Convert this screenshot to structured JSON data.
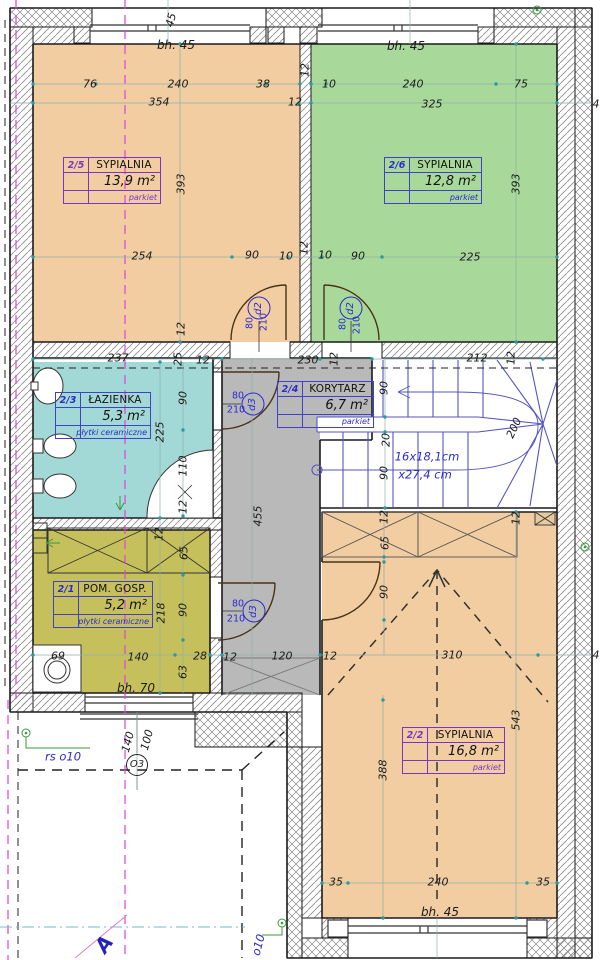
{
  "palette": {
    "bedroom_fill": "#f1cda1",
    "bedroom2_fill": "#a9d89b",
    "bath_fill": "#a2d8d5",
    "utility_fill": "#c6c05c",
    "corridor_fill": "#b9b9b9",
    "stair_line": "#5555c5",
    "label_blue": "#2b2bd0",
    "label_purple": "#7a35c8",
    "tick_teal": "#2e9aa0",
    "axis_magenta": "#e040e0"
  },
  "plan": {
    "rooms": [
      {
        "id": "2/5",
        "name": "SYPIALNIA",
        "area": "13,9 m²",
        "finish": "parkiet"
      },
      {
        "id": "2/6",
        "name": "SYPIALNIA",
        "area": "12,8 m²",
        "finish": "parkiet"
      },
      {
        "id": "2/3",
        "name": "ŁAZIENKA",
        "area": "5,3 m²",
        "finish": "płytki ceramiczne"
      },
      {
        "id": "2/4",
        "name": "KORYTARZ",
        "area": "6,7 m²",
        "finish": "parkiet"
      },
      {
        "id": "2/1",
        "name": "POM. GOSP.",
        "area": "5,2 m²",
        "finish": "płytki ceramiczne"
      },
      {
        "id": "2/2",
        "name": "SYPIALNIA",
        "area": "16,8 m²",
        "finish": "parkiet"
      }
    ]
  },
  "annotations": {
    "dims": [
      {
        "t": "76",
        "x": 90,
        "y": 84
      },
      {
        "t": "240",
        "x": 178,
        "y": 84
      },
      {
        "t": "38",
        "x": 263,
        "y": 84
      },
      {
        "t": "10",
        "x": 329,
        "y": 84
      },
      {
        "t": "240",
        "x": 413,
        "y": 84
      },
      {
        "t": "75",
        "x": 521,
        "y": 84
      },
      {
        "t": "354",
        "x": 159,
        "y": 102
      },
      {
        "t": "12",
        "x": 295,
        "y": 102
      },
      {
        "t": "325",
        "x": 432,
        "y": 104
      },
      {
        "t": "12",
        "x": 305,
        "y": 70,
        "r": -90
      },
      {
        "t": "bh. 45",
        "x": 176,
        "y": 45,
        "cls": "bh"
      },
      {
        "t": "bh. 45",
        "x": 406,
        "y": 46,
        "cls": "bh"
      },
      {
        "t": "393",
        "x": 181,
        "y": 184,
        "r": -90
      },
      {
        "t": "393",
        "x": 516,
        "y": 184,
        "r": -90
      },
      {
        "t": "254",
        "x": 142,
        "y": 256
      },
      {
        "t": "90",
        "x": 252,
        "y": 255
      },
      {
        "t": "10",
        "x": 286,
        "y": 256
      },
      {
        "t": "10",
        "x": 325,
        "y": 255
      },
      {
        "t": "90",
        "x": 358,
        "y": 256
      },
      {
        "t": "225",
        "x": 470,
        "y": 257
      },
      {
        "t": "12",
        "x": 181,
        "y": 329,
        "r": -90
      },
      {
        "t": "12",
        "x": 304,
        "y": 248,
        "r": -90
      },
      {
        "t": "237",
        "x": 118,
        "y": 358
      },
      {
        "t": "25",
        "x": 178,
        "y": 359,
        "r": -90
      },
      {
        "t": "12",
        "x": 203,
        "y": 360
      },
      {
        "t": "230",
        "x": 308,
        "y": 360
      },
      {
        "t": "12",
        "x": 334,
        "y": 359,
        "r": -90
      },
      {
        "t": "212",
        "x": 477,
        "y": 358
      },
      {
        "t": "12",
        "x": 511,
        "y": 358,
        "r": -90
      },
      {
        "t": "90",
        "x": 183,
        "y": 398,
        "r": -90
      },
      {
        "t": "225",
        "x": 160,
        "y": 432,
        "r": -90
      },
      {
        "t": "110",
        "x": 183,
        "y": 466,
        "r": -90
      },
      {
        "t": "12",
        "x": 183,
        "y": 507,
        "r": -90
      },
      {
        "t": "455",
        "x": 258,
        "y": 516,
        "r": -90
      },
      {
        "t": "90",
        "x": 384,
        "y": 388,
        "r": -90
      },
      {
        "t": "20",
        "x": 386,
        "y": 440,
        "r": -90
      },
      {
        "t": "90",
        "x": 384,
        "y": 473,
        "r": -90
      },
      {
        "t": "200",
        "x": 514,
        "y": 428,
        "r": -65
      },
      {
        "t": "16x18,1cm",
        "x": 427,
        "y": 457,
        "cls": "blue-it"
      },
      {
        "t": "x27,4 cm",
        "x": 425,
        "y": 475,
        "cls": "blue-it"
      },
      {
        "t": "12",
        "x": 159,
        "y": 534,
        "r": -90
      },
      {
        "t": "65",
        "x": 184,
        "y": 553,
        "r": -90
      },
      {
        "t": "90",
        "x": 183,
        "y": 610,
        "r": -90
      },
      {
        "t": "63",
        "x": 183,
        "y": 672,
        "r": -90
      },
      {
        "t": "218",
        "x": 161,
        "y": 613,
        "r": -90
      },
      {
        "t": "69",
        "x": 58,
        "y": 656
      },
      {
        "t": "140",
        "x": 138,
        "y": 657
      },
      {
        "t": "28",
        "x": 200,
        "y": 656
      },
      {
        "t": "12",
        "x": 230,
        "y": 657
      },
      {
        "t": "120",
        "x": 282,
        "y": 656
      },
      {
        "t": "bh. 70",
        "x": 136,
        "y": 688,
        "cls": "bh"
      },
      {
        "t": "12",
        "x": 384,
        "y": 517,
        "r": -90
      },
      {
        "t": "65",
        "x": 385,
        "y": 543,
        "r": -90
      },
      {
        "t": "90",
        "x": 384,
        "y": 592,
        "r": -90
      },
      {
        "t": "12",
        "x": 516,
        "y": 518,
        "r": -90
      },
      {
        "t": "12",
        "x": 330,
        "y": 656
      },
      {
        "t": "310",
        "x": 452,
        "y": 655
      },
      {
        "t": "4",
        "x": 596,
        "y": 655
      },
      {
        "t": "543",
        "x": 516,
        "y": 720,
        "r": -90
      },
      {
        "t": "388",
        "x": 383,
        "y": 770,
        "r": -90
      },
      {
        "t": "35",
        "x": 336,
        "y": 882
      },
      {
        "t": "240",
        "x": 438,
        "y": 882
      },
      {
        "t": "35",
        "x": 543,
        "y": 882
      },
      {
        "t": "bh. 45",
        "x": 440,
        "y": 912,
        "cls": "bh"
      },
      {
        "t": "4",
        "x": 596,
        "y": 104
      },
      {
        "t": "140",
        "x": 128,
        "y": 742,
        "r": -75
      },
      {
        "t": "100",
        "x": 147,
        "y": 740,
        "r": -75
      },
      {
        "t": "rs o10",
        "x": 63,
        "y": 757,
        "cls": "blue-it"
      },
      {
        "t": "o10",
        "x": 259,
        "y": 945,
        "r": -75,
        "cls": "blue-it"
      },
      {
        "t": "45",
        "x": 171,
        "y": 20,
        "r": -75
      },
      {
        "t": "80",
        "x": 250,
        "y": 323,
        "r": -90,
        "cls": "blue-sm"
      },
      {
        "t": "210",
        "x": 264,
        "y": 322,
        "r": -90,
        "cls": "blue-sm"
      },
      {
        "t": "80",
        "x": 343,
        "y": 324,
        "r": -90,
        "cls": "blue-sm"
      },
      {
        "t": "210",
        "x": 357,
        "y": 325,
        "r": -90,
        "cls": "blue-sm"
      },
      {
        "t": "80",
        "x": 238,
        "y": 396,
        "cls": "blue-sm"
      },
      {
        "t": "210",
        "x": 236,
        "y": 410,
        "cls": "blue-sm"
      },
      {
        "t": "80",
        "x": 238,
        "y": 604,
        "cls": "blue-sm"
      },
      {
        "t": "210",
        "x": 236,
        "y": 619,
        "cls": "blue-sm"
      },
      {
        "t": "A",
        "x": 104,
        "y": 944,
        "r": -55,
        "cls": "section"
      }
    ],
    "markers": [
      {
        "t": "d2",
        "x": 259,
        "y": 308
      },
      {
        "t": "d2",
        "x": 351,
        "y": 308
      },
      {
        "t": "d3",
        "x": 253,
        "y": 404
      },
      {
        "t": "d3",
        "x": 254,
        "y": 611
      },
      {
        "t": "O3",
        "x": 137,
        "y": 765,
        "cls": "black"
      }
    ]
  }
}
